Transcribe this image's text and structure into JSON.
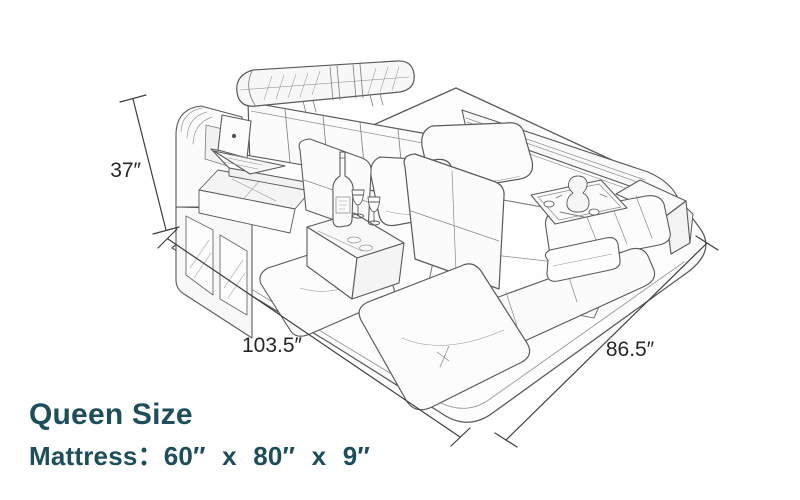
{
  "diagram": {
    "subject": "Isometric pencil-style line drawing of a multifunctional queen bed with storage tower, swivel laptop desk, headrest bolster, pillows, chair seats, wine table, tea tray, LED side rail and ottoman",
    "stroke_color": "#5a5a5a",
    "dimension_line_color": "#3c3c3c",
    "dimension_label_color": "#262626",
    "dimensions": {
      "height_label": "37″",
      "front_width_label": "103.5″",
      "side_depth_label": "86.5″"
    }
  },
  "caption": {
    "title": "Queen Size",
    "mattress_spec": "Mattress：60″ x 80″ x 9″",
    "text_color": "#1d4e5c"
  }
}
